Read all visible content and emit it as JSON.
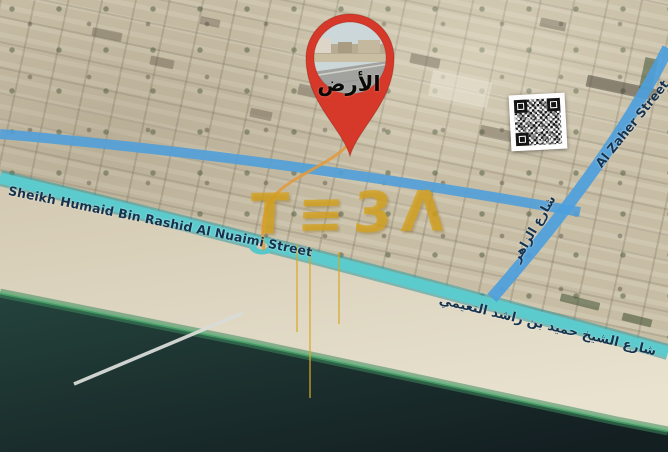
{
  "map": {
    "kind": "satellite-aerial-listing-map",
    "pin": {
      "label": "الأرض"
    },
    "street_labels": {
      "sheikh_humaid_en": "Sheikh Humaid Bin Rashid Al Nuaimi Street",
      "sheikh_humaid_ar": "شارع الشيخ حميد بن راشد النعيمي",
      "al_zaher_en": "Al Zaher Street",
      "al_zaher_ar": "شارع الزاهر"
    },
    "watermark": {
      "text": "T≡3Λ"
    },
    "icons": {
      "pin": "location-pin-icon",
      "qr": "qr-code"
    },
    "colors": {
      "pin_red": "#d63829",
      "coastal_street_teal": "#56c8ca",
      "street_blue": "#539fd8",
      "label_navy": "#16334e",
      "watermark_gold": "#d5a21c",
      "water_deep": "#1b2c2a",
      "water_shallow": "#3d8a5c",
      "sand": "#e0d8c3",
      "urban_base": "#c7bda5"
    }
  }
}
